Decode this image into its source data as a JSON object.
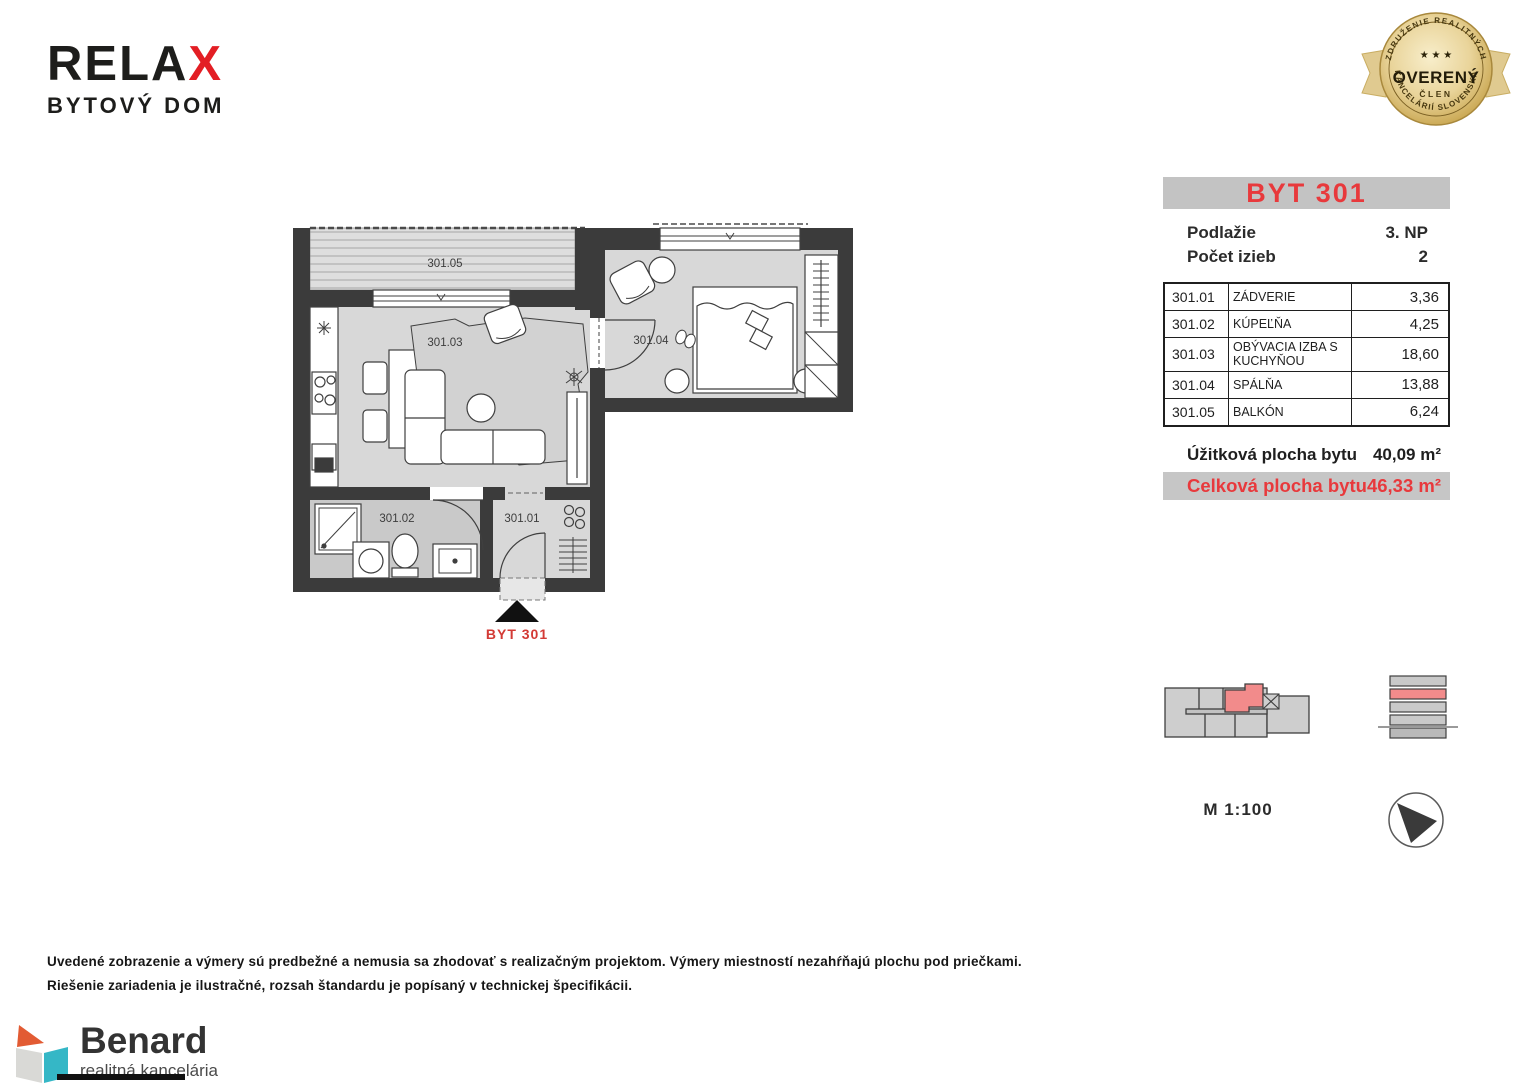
{
  "brand": {
    "name_black": "RELA",
    "name_red": "X",
    "subtitle": "BYTOVÝ DOM"
  },
  "badge": {
    "arc_top": "ZDRUŽENIE REALITNÝCH",
    "arc_bottom": "KANCELÁRIÍ SLOVENSKA",
    "stars": "★ ★ ★",
    "title": "OVERENÝ",
    "subtitle": "ČLEN"
  },
  "info": {
    "title": "BYT 301",
    "meta": [
      {
        "label": "Podlažie",
        "value": "3. NP"
      },
      {
        "label": "Počet izieb",
        "value": "2"
      }
    ],
    "rooms": [
      {
        "code": "301.01",
        "name": "ZÁDVERIE",
        "area": "3,36"
      },
      {
        "code": "301.02",
        "name": "KÚPEĽŇA",
        "area": "4,25"
      },
      {
        "code": "301.03",
        "name": "OBÝVACIA IZBA S KUCHYŇOU",
        "area": "18,60"
      },
      {
        "code": "301.04",
        "name": "SPÁLŇA",
        "area": "13,88"
      },
      {
        "code": "301.05",
        "name": "BALKÓN",
        "area": "6,24"
      }
    ],
    "usable_label": "Úžitková plocha bytu",
    "usable_value": "40,09 m²",
    "total_label": "Celková plocha bytu",
    "total_value": "46,33 m²"
  },
  "plan": {
    "labels": {
      "balcony": "301.05",
      "living": "301.03",
      "bedroom": "301.04",
      "bathroom": "301.02",
      "hall": "301.01"
    },
    "marker": "BYT 301"
  },
  "scale_label": "M 1:100",
  "disclaimer": [
    "Uvedené zobrazenie a výmery sú predbežné a nemusia sa zhodovať s realizačným projektom. Výmery miestností nezahŕňajú plochu pod priečkami.",
    "Riešenie zariadenia je ilustračné, rozsah štandardu je popísaný v technickej špecifikácii."
  ],
  "footer_brand": {
    "name": "Benard",
    "subtitle": "realitná kancelária"
  },
  "colors": {
    "accent_red": "#e8393c",
    "logo_red": "#e31e24",
    "highlight_salmon": "#f28b8b",
    "wall_dark": "#3b3b3b",
    "floor_gray": "#d8d8d8",
    "bath_gray": "#c9c9c9",
    "header_gray": "#c3c3c3",
    "badge_gold": "#d9bd7f",
    "benard_orange": "#e25b33",
    "benard_teal": "#35b7c6"
  }
}
